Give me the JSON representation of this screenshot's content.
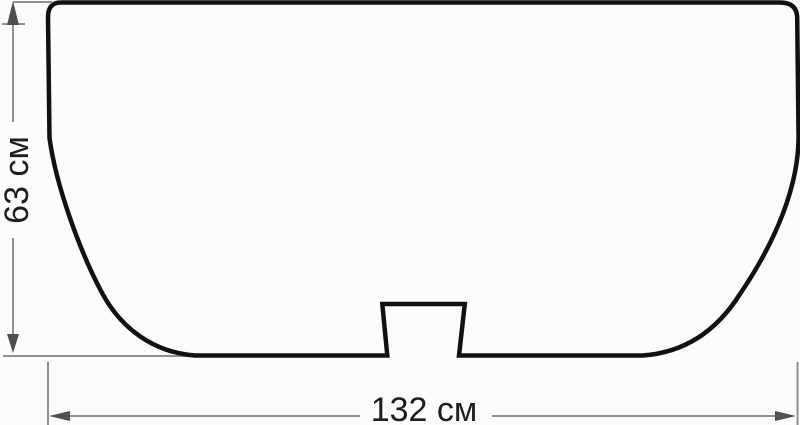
{
  "diagram": {
    "description": "Technical outline drawing (front profile of a tub/basin shaped panel) with overall dimension annotations",
    "height_dimension": {
      "label": "63 см",
      "value": 63,
      "unit": "см"
    },
    "width_dimension": {
      "label": "132 см",
      "value": 132,
      "unit": "см"
    },
    "colors": {
      "background": "#fcfcfc",
      "outline": "#111111",
      "dimension_line": "#919191",
      "arrowhead": "#4f4f4f",
      "label_text": "#1d1d1d"
    }
  }
}
